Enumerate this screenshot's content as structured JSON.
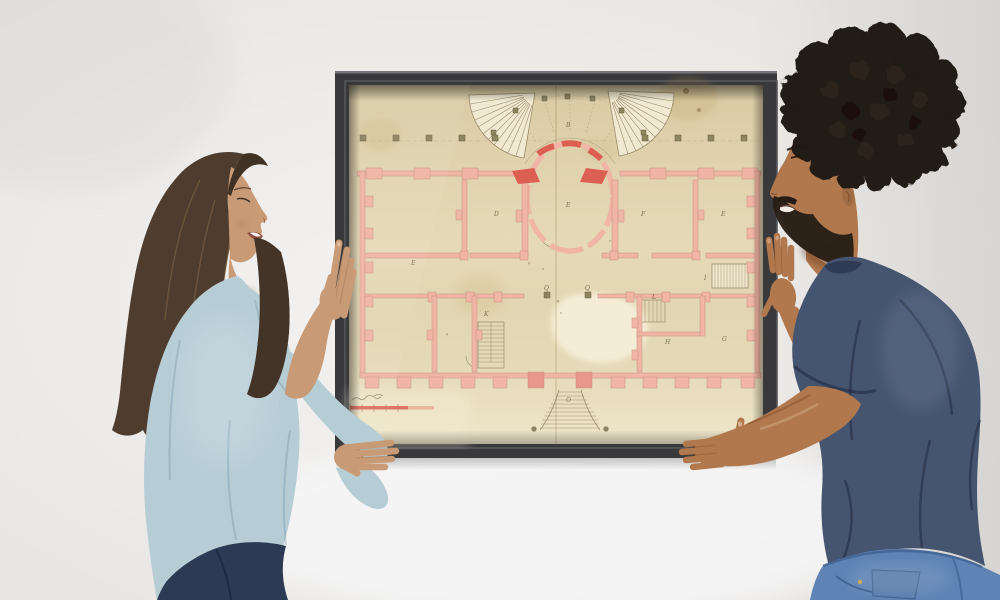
{
  "scene": {
    "title": "Couple hanging a framed vintage floor plan on a wall",
    "left_person": "woman with long brown hair, light blue shirt, dark jeans",
    "right_person": "man with curly dark hair and beard, navy t-shirt, blue jeans",
    "artwork": "aged architectural floor plan with pink walls, central oval room, fan staircases, in a dark frame"
  },
  "plan": {
    "letters": [
      "B",
      "D",
      "E",
      "F",
      "E",
      "E",
      "K",
      "L",
      "H",
      "G",
      "I",
      "O",
      "Q",
      "Q"
    ]
  },
  "colors": {
    "wall": "#e8e6e3",
    "wall_bright": "#f7f7f8",
    "frame": "#39393b",
    "frame_lip": "#55565b",
    "paper": "#eadfbc",
    "paper_light": "#f6efd9",
    "plan_pink": "#f0b5a4",
    "plan_red": "#dd5f53",
    "plan_line": "#9b8c6c",
    "plan_olive": "#8d8460",
    "plan_ink": "#6b5d42",
    "woman_shirt": "#b7cdd6",
    "woman_jeans": "#2d3a54",
    "woman_hair": "#4e3d2e",
    "woman_skin": "#c89a75",
    "man_shirt": "#45546f",
    "man_jeans": "#5e83b4",
    "man_hair": "#211a13",
    "man_skin": "#b1784e"
  }
}
